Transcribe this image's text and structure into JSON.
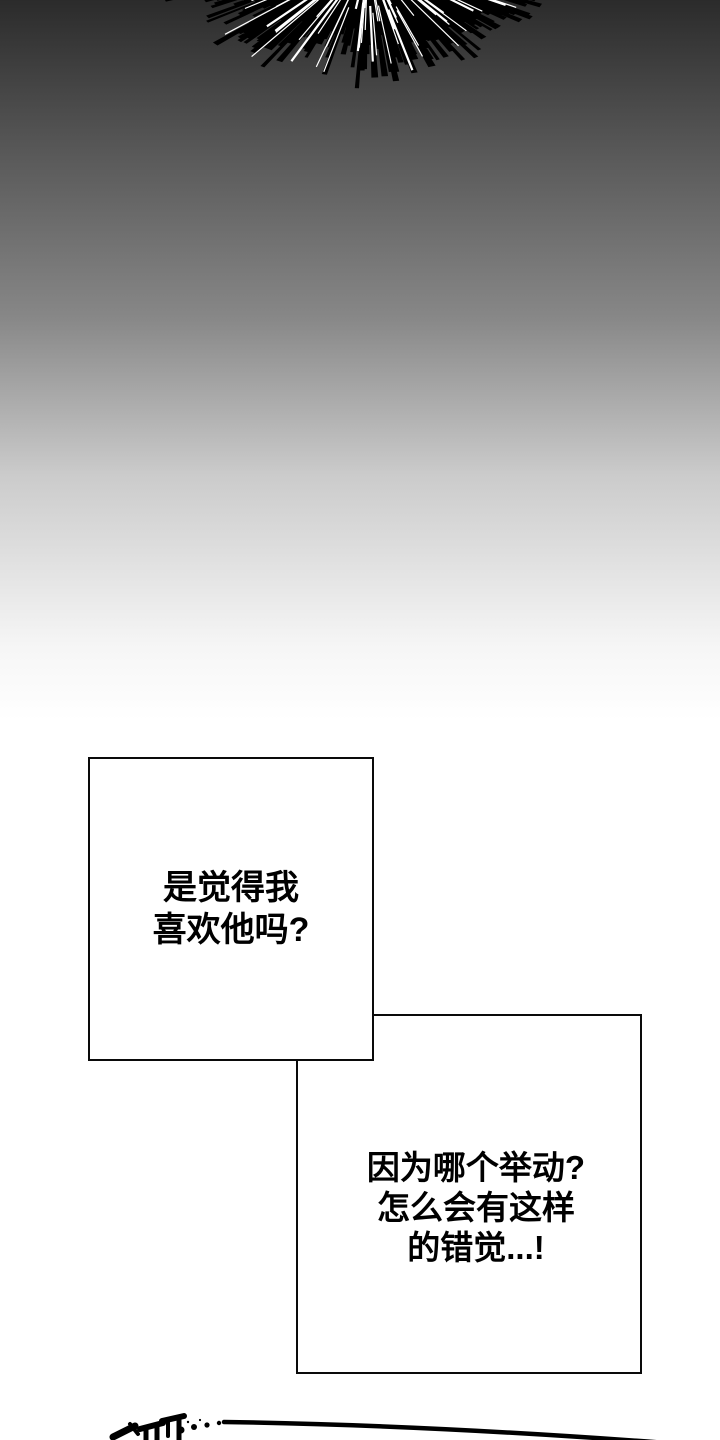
{
  "page": {
    "kind": "webtoon-comic-panel-page"
  },
  "panels": {
    "thought_box_1": {
      "lines": [
        "是觉得我",
        "喜欢他吗?"
      ]
    },
    "thought_box_2": {
      "lines": [
        "因为哪个举动?",
        "怎么会有这样",
        "的错觉...!"
      ]
    }
  },
  "decor": {
    "burst": "radial-speed-line-burst",
    "sfx": "cut-off-hand-drawn-sound-effect-with-dots-and-curve"
  },
  "colors": {
    "background_top": "#2b2b2b",
    "background_bottom": "#ffffff",
    "panel_fill": "#ffffff",
    "panel_border": "#0a0a0a",
    "text": "#000000",
    "burst_ink": "#000000",
    "burst_streaks": "#ffffff"
  }
}
